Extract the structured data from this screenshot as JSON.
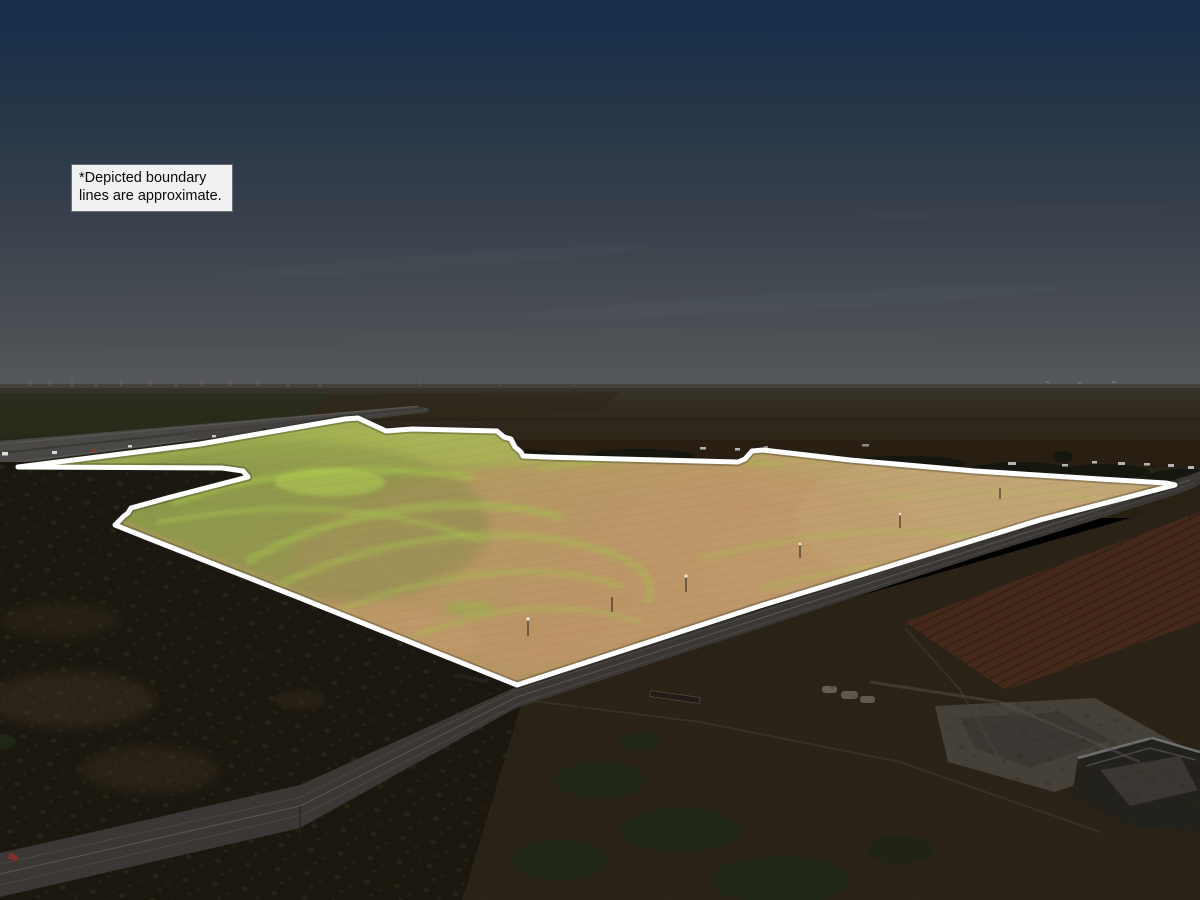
{
  "annotation": {
    "line1": "*Depicted boundary",
    "line2": "lines are approximate."
  },
  "boundary": {
    "points": "18,467 200,444 345,419 358,418 386,431 412,429 455,430 497,431 504,437 511,439 515,447 521,452 523,456 545,457 620,459 738,462 745,459 752,451 763,450 850,460 975,471 1100,479 1166,483 1175,485 1040,520 975,540 760,606 600,658 517,685 300,598 150,539 115,525 124,516 128,513 131,508 167,498 248,477 243,471 222,468",
    "stroke_color": "#ffffff",
    "stroke_width": "5"
  },
  "palette": {
    "sky_top": "#152e4b",
    "sky_mid": "#36404b",
    "sky_horizon": "#55575a",
    "plains_dark_brown": "#2c2418",
    "field_green": "#95a64c",
    "field_olive": "#8c8f4e",
    "field_tan": "#c2a06c",
    "swirl_bright_green": "#a6c44d",
    "brush_dark": "#1b170f",
    "road_asphalt": "#3a3734",
    "highway_gray": "#4a4846",
    "boundary_white": "#ffffff",
    "annotation_bg": "#f1f1f1",
    "annotation_text": "#0a0a0a"
  }
}
